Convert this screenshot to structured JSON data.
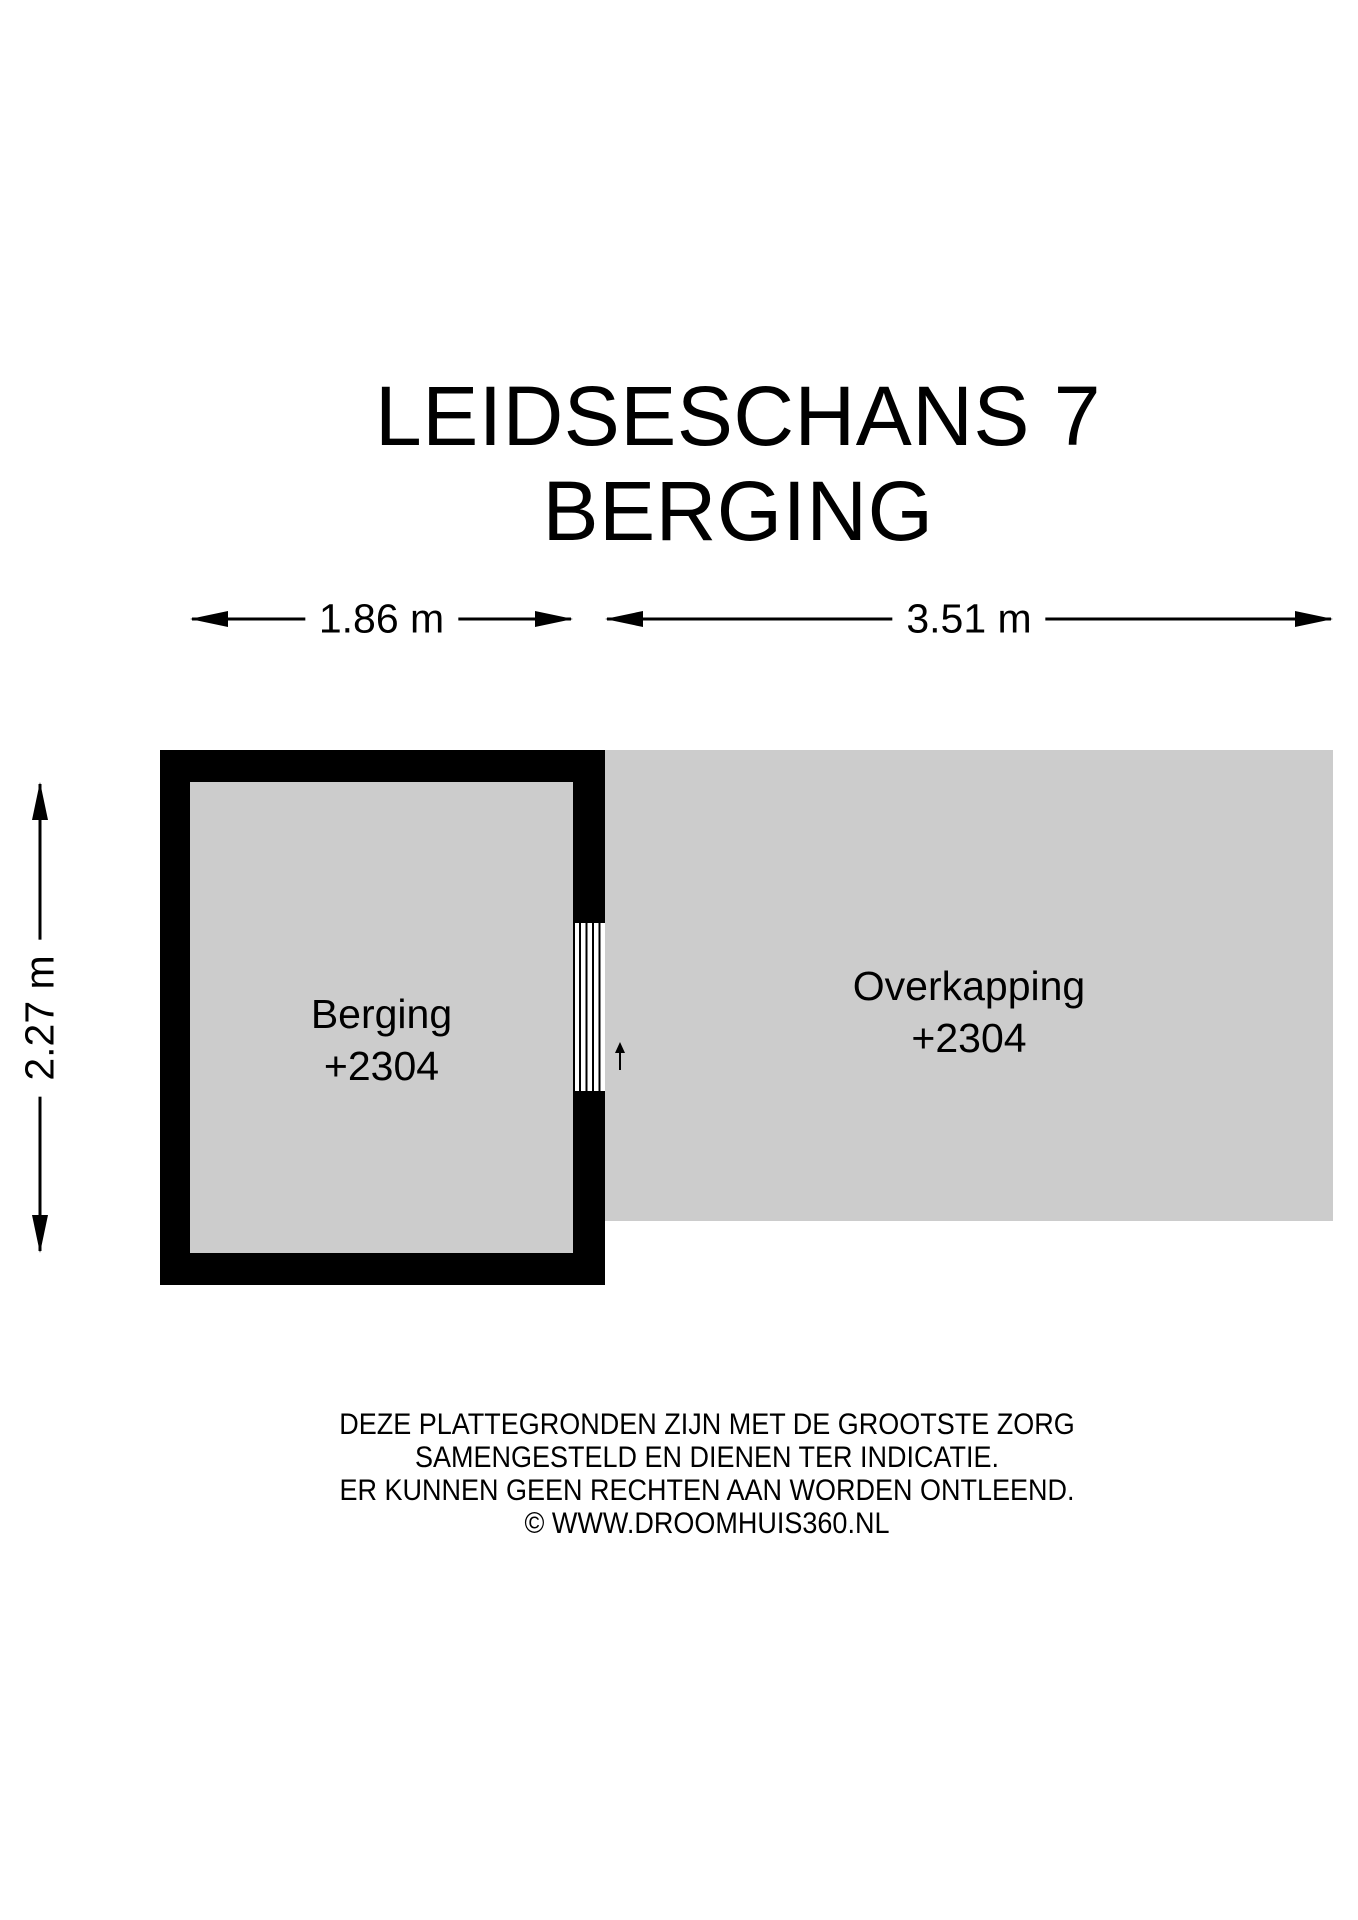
{
  "title": {
    "line1": "LEIDSESCHANS 7",
    "line2": "BERGING"
  },
  "dimensions": {
    "berging_width": {
      "label": "1.86 m",
      "orientation": "horizontal"
    },
    "overkapping_width": {
      "label": "3.51 m",
      "orientation": "horizontal"
    },
    "berging_height": {
      "label": "2.27 m",
      "orientation": "vertical"
    }
  },
  "rooms": {
    "berging": {
      "name": "Berging",
      "level": "+2304"
    },
    "overkapping": {
      "name": "Overkapping",
      "level": "+2304"
    }
  },
  "icons": {
    "door_swing": "door-swing-up-arrow"
  },
  "footer": {
    "lines": [
      "DEZE PLATTEGRONDEN ZIJN MET DE GROOTSTE ZORG",
      "SAMENGESTELD EN DIENEN TER INDICATIE.",
      "ER KUNNEN GEEN RECHTEN AAN WORDEN ONTLEEND.",
      "© WWW.DROOMHUIS360.NL"
    ]
  },
  "colors": {
    "wall": "#000000",
    "floor": "#cccccc",
    "background": "#ffffff",
    "text": "#000000"
  }
}
